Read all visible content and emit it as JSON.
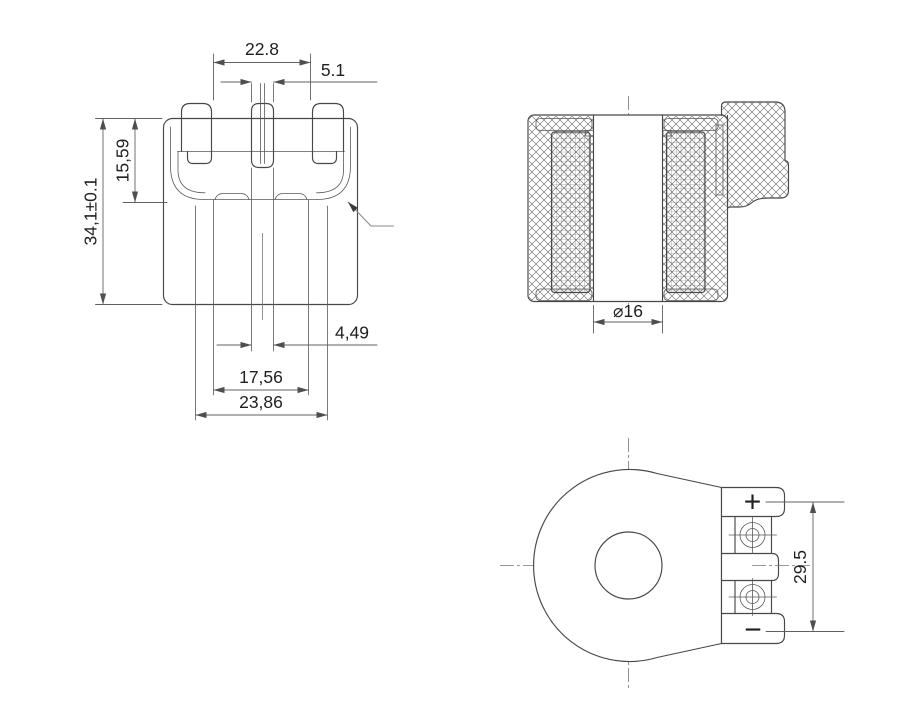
{
  "page": {
    "background": "#ffffff"
  },
  "drawing": {
    "line_color": "#474747",
    "dim_color": "#616161",
    "views": {
      "front": {
        "title": "front-view",
        "dims": {
          "tab_span": "22.8",
          "center_tab": "5.1",
          "upper_height": "15,59",
          "total_height": "34,1±0.1",
          "slot_width": "4,49",
          "inner_width": "17,56",
          "outer_width": "23,86"
        }
      },
      "section": {
        "title": "section-view",
        "dims": {
          "bore": "⌀16"
        }
      },
      "bottom": {
        "title": "bottom-view",
        "dims": {
          "terminal_pitch": "29.5"
        },
        "labels": {
          "positive": "+",
          "negative": "−"
        }
      }
    }
  }
}
